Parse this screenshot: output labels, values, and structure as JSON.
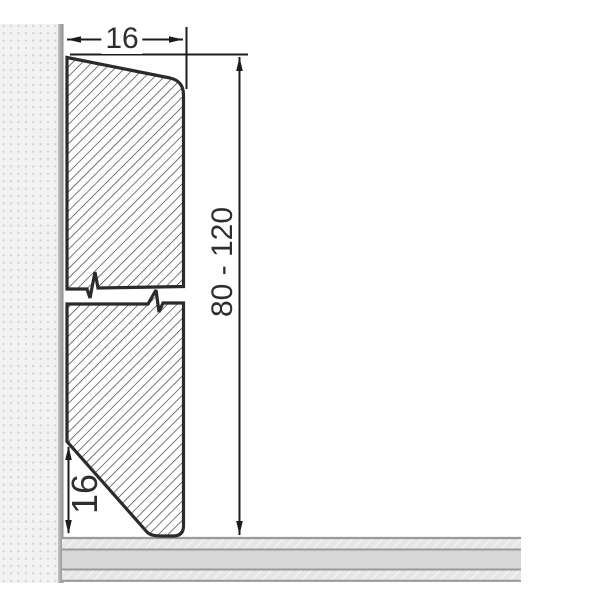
{
  "drawing_type": "skirting-board-profile-cross-section",
  "labels": {
    "width": "16",
    "height_range": "80 - 120",
    "bottom_height": "16"
  },
  "colors": {
    "outline": "#2b2b2b",
    "hatch_line": "#3f3f3f",
    "dimension_line": "#1c1c1c",
    "text": "#2e2e2e",
    "wall_background": "#f2f2f2",
    "wall_dot": "#d2d2d2",
    "wall_edge_light": "#c2c2c2",
    "wall_edge_dark": "#8e8e8e",
    "floor_hatch_background": "#e6e6e6",
    "floor_hatch_line": "#f7f7f7",
    "floor_middle_band": "#d7d7d7",
    "floor_border": "#9a9a9a",
    "background": "#ffffff"
  }
}
